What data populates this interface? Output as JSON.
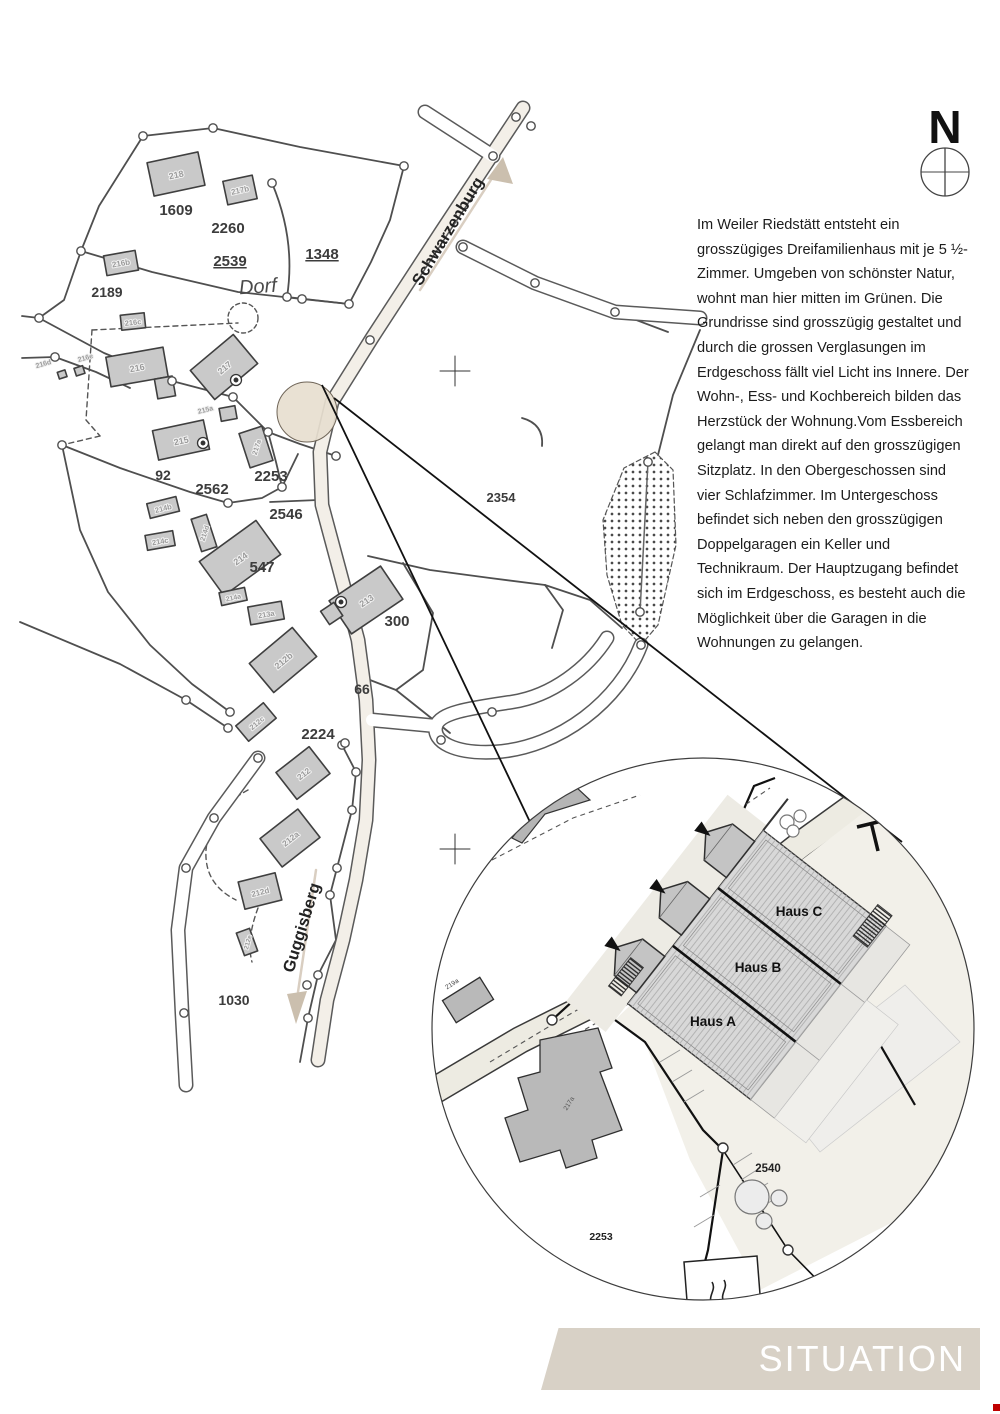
{
  "compass": {
    "label": "N"
  },
  "description": {
    "text": "Im Weiler Riedstätt entsteht ein grosszügiges Dreifamilienhaus mit je 5 ½-Zimmer. Umgeben von schönster Natur, wohnt man hier mitten im Grünen. Die Grundrisse sind grosszügig gestaltet und durch die grossen Verglasungen im Erdgeschoss fällt viel Licht ins Innere. Der Wohn-, Ess- und Kochbereich bilden das Herzstück der Wohnung.Vom Essbereich gelangt man direkt auf den grosszügigen Sitzplatz. In den Obergeschossen sind vier Schlafzimmer. Im Untergeschoss befindet sich neben den grosszügigen Doppelgaragen ein Keller und Technikraum. Der Hauptzugang befindet sich im Erdgeschoss, es besteht auch die Möglichkeit über die Garagen in die Wohnungen zu gelangen."
  },
  "map": {
    "streets": {
      "schwarzenburg": "Schwarzenburg",
      "guggisberg": "Guggisberg"
    },
    "area_label": "Dorf",
    "parcel_labels": {
      "p1609": "1609",
      "p2260": "2260",
      "p2539": "2539",
      "p1348": "1348",
      "p2189": "2189",
      "p92": "92",
      "p2562": "2562",
      "p2253": "2253",
      "p2546": "2546",
      "p547": "547",
      "p300": "300",
      "p66": "66",
      "p2224": "2224",
      "p2354": "2354",
      "p1030": "1030"
    },
    "building_labels": {
      "b218": "218",
      "b217b": "217b",
      "b216b": "216b",
      "b216c": "216c",
      "b216e": "216e",
      "b216d": "216d",
      "b216": "216",
      "b217": "217",
      "b215a": "215a",
      "b215": "215",
      "b217a": "217a",
      "b214b": "214b",
      "b214c": "214c",
      "b214d": "214d",
      "b214": "214",
      "b214a": "214a",
      "b213a": "213a",
      "b213": "213",
      "b212b": "212b",
      "b212c": "212c",
      "b212": "212",
      "b212a": "212a",
      "b212d": "212d",
      "b212e": "212e"
    }
  },
  "detail": {
    "house_labels": {
      "a": "Haus A",
      "b": "Haus B",
      "c": "Haus C"
    },
    "parcel_labels": {
      "p2540": "2540",
      "p2253": "2253"
    },
    "building_labels": {
      "b217a": "217a",
      "b219a": "219a"
    }
  },
  "footer": {
    "title": "SITUATION"
  },
  "colors": {
    "banner_beige": "#d8d1c6",
    "highlight_beige": "#e7decf",
    "red_mark": "#c00000"
  }
}
